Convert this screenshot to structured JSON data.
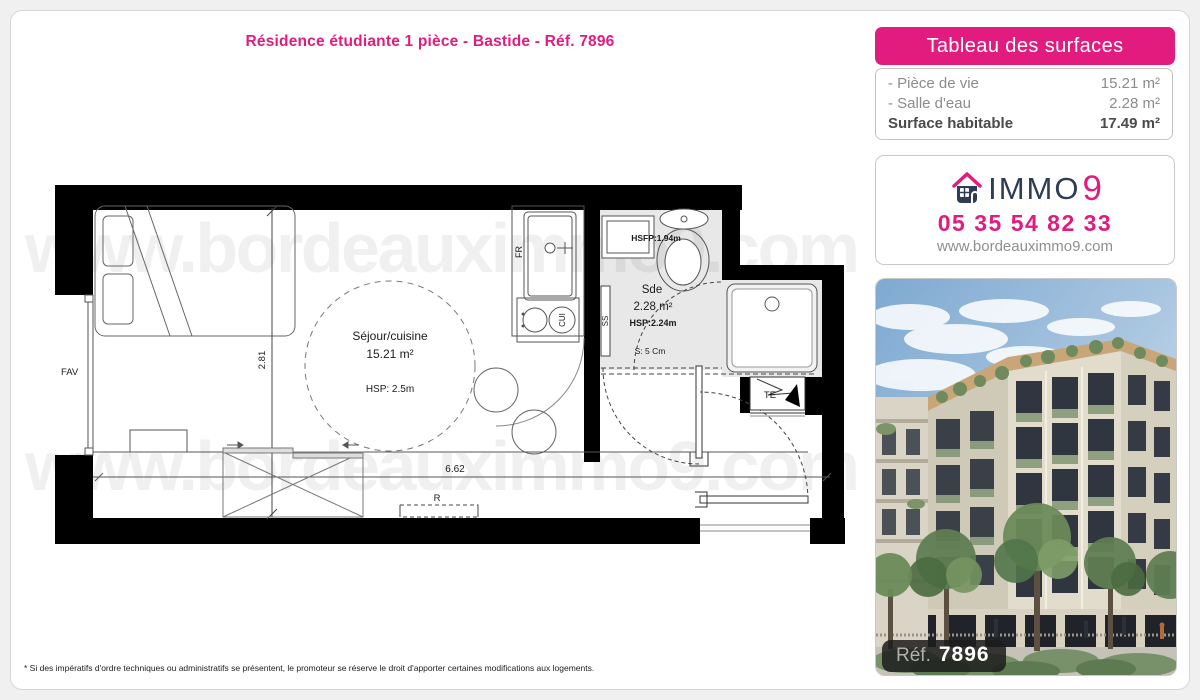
{
  "page": {
    "title": "Résidence étudiante 1 pièce - Bastide - Réf. 7896",
    "disclaimer": "* Si des impératifs d'ordre techniques ou administratifs se présentent, le promoteur se réserve le droit d'apporter certaines modifications aux logements."
  },
  "surfaces_panel": {
    "header": "Tableau des surfaces",
    "rows": [
      {
        "label": "- Pièce de vie",
        "value": "15.21 m²"
      },
      {
        "label": "- Salle d'eau",
        "value": "2.28 m²"
      }
    ],
    "total_label": "Surface habitable",
    "total_value": "17.49 m²"
  },
  "agency": {
    "brand_immo": "IMMO",
    "brand_nine": "9",
    "phone": "05 35 54 82 33",
    "website": "www.bordeauximmo9.com"
  },
  "photo": {
    "ref_label": "Réf.",
    "ref_number": "7896"
  },
  "floorplan": {
    "watermark": "www.bordeauximmo9.com",
    "rooms": {
      "living": {
        "name": "Séjour/cuisine",
        "area": "15.21 m²",
        "hsp": "HSP: 2.5m"
      },
      "bathroom": {
        "name": "Sde",
        "area": "2.28 m²",
        "hsp": "HSP:2.24m",
        "hsfp": "HSFP:1.94m",
        "shower_note": "S: 5 Cm"
      }
    },
    "labels": {
      "window": "FAV",
      "fridge": "FR",
      "cooktop": "CUI",
      "duct": "SS",
      "electrical": "TE",
      "radiator": "R"
    },
    "dimensions": {
      "width": "6.62",
      "height": "2.81"
    }
  },
  "colors": {
    "accent": "#e21c7f",
    "navy": "#2e3c55",
    "bath_floor": "#e8e8e8"
  }
}
